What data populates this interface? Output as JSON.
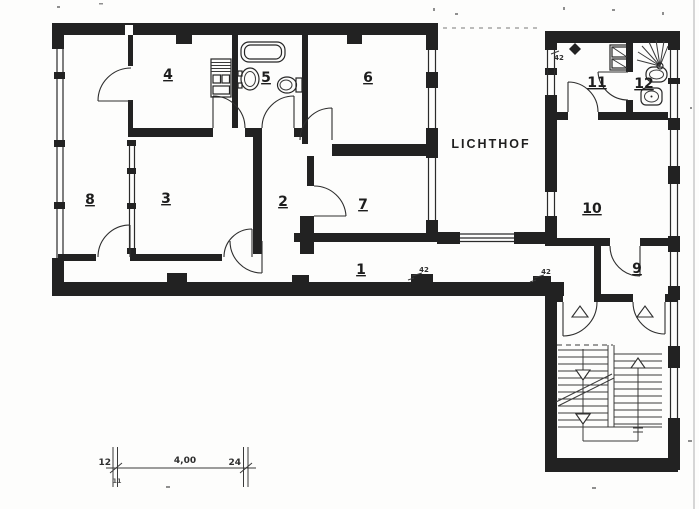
{
  "document": {
    "type": "scanned apartment floor plan",
    "courtyard_label": "LICHTHOF"
  },
  "colors": {
    "ink": "#222222",
    "paper": "#fdfdfc"
  },
  "rooms": {
    "r1": "1",
    "r2": "2",
    "r3": "3",
    "r4": "4",
    "r5": "5",
    "r6": "6",
    "r7": "7",
    "r8": "8",
    "r9": "9",
    "r10": "10",
    "r11": "11",
    "r12": "12"
  },
  "wall_annotations": {
    "corridor_left": "42",
    "corridor_right": "42",
    "top_right": "42"
  },
  "dimension_line": {
    "left_value": "12",
    "span_value": "4,00",
    "right_value": "24",
    "tick_note": "11"
  }
}
